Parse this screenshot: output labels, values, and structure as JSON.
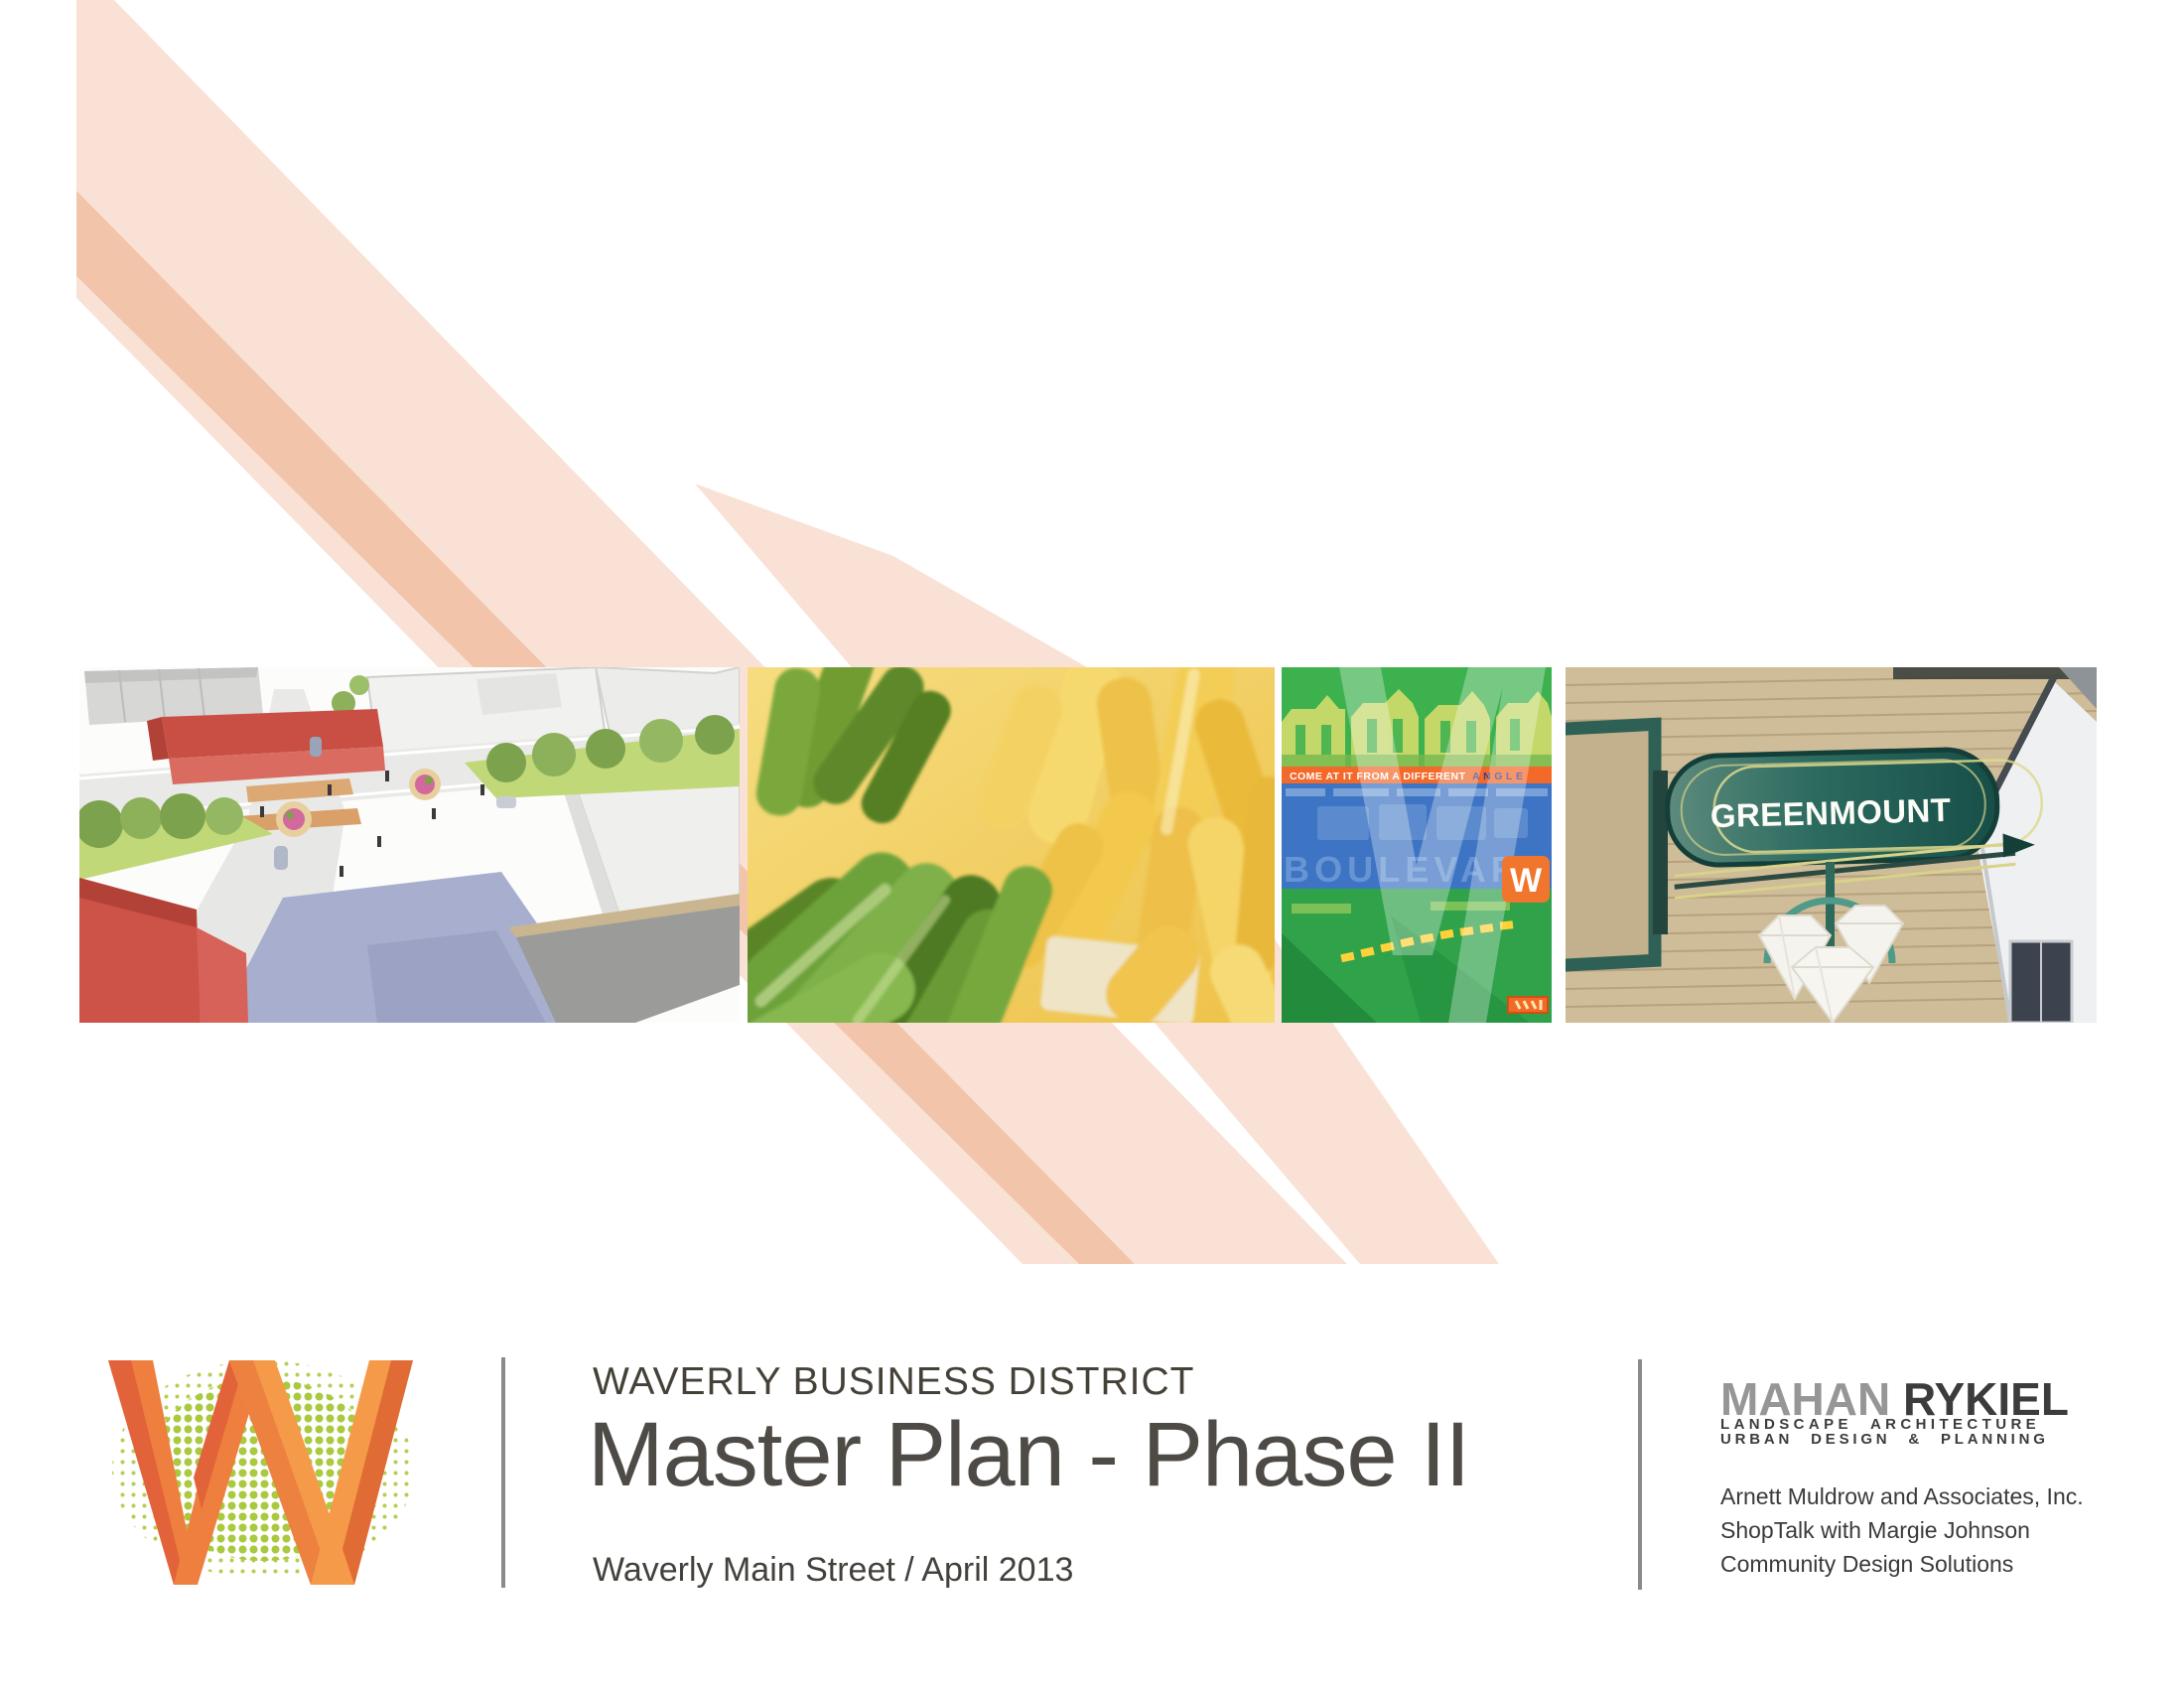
{
  "stripes": {
    "light": "#f9e2d5",
    "dark": "#f2c5ab"
  },
  "title_block": {
    "eyebrow": "WAVERLY BUSINESS DISTRICT",
    "title": "Master Plan - Phase II",
    "subtitle": "Waverly Main Street / April 2013"
  },
  "branding": {
    "firm_name_1": "MAHAN",
    "firm_name_2": "RYKIEL",
    "tagline_line1": "LANDSCAPE ARCHITECTURE",
    "tagline_line2": "URBAN DESIGN & PLANNING",
    "credits": [
      "Arnett Muldrow and Associates, Inc.",
      "ShopTalk with Margie Johnson",
      "Community Design Solutions"
    ]
  },
  "photos": {
    "poster": {
      "headline_white": "COME AT IT FROM A DIFFERENT",
      "headline_accent": "ANGLE",
      "ghost_text": "BOULEVARD",
      "badge_letter": "W"
    },
    "sign_text": "GREENMOUNT"
  },
  "logo": {
    "letter": "W"
  }
}
